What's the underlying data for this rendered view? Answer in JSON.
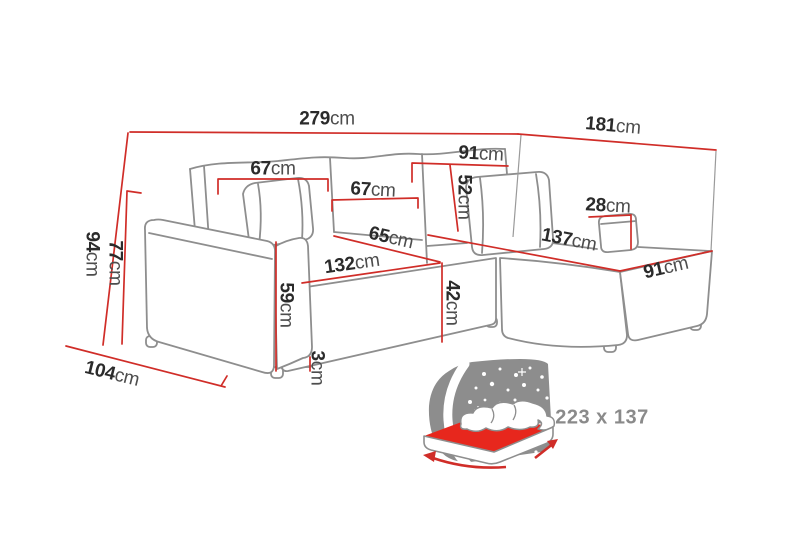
{
  "diagram": {
    "description": "corner-sofa-with-dimensions",
    "unit": "cm",
    "colors": {
      "dimension_line_red": "#d02d28",
      "sofa_outline_gray": "#8e8e8e",
      "number_text": "#2b2b2b",
      "unit_text": "#4d4d4d",
      "icon_gray": "#8d8d8d",
      "mattress_red": "#e7271d",
      "background": "#ffffff"
    }
  },
  "dimensions": [
    {
      "name": "total-width",
      "value": "279",
      "unit": "cm"
    },
    {
      "name": "chaise-side-depth",
      "value": "181",
      "unit": "cm"
    },
    {
      "name": "backrest-section-width",
      "value": "91",
      "unit": "cm"
    },
    {
      "name": "back-cushion-left",
      "value": "67",
      "unit": "cm"
    },
    {
      "name": "back-cushion-middle",
      "value": "67",
      "unit": "cm"
    },
    {
      "name": "backrest-height",
      "value": "52",
      "unit": "cm"
    },
    {
      "name": "right-armrest-height",
      "value": "28",
      "unit": "cm"
    },
    {
      "name": "total-height",
      "value": "94",
      "unit": "cm"
    },
    {
      "name": "arm-back-height",
      "value": "77",
      "unit": "cm"
    },
    {
      "name": "chaise-length",
      "value": "137",
      "unit": "cm"
    },
    {
      "name": "seat-depth",
      "value": "65",
      "unit": "cm"
    },
    {
      "name": "seat-width",
      "value": "132",
      "unit": "cm"
    },
    {
      "name": "chaise-width",
      "value": "91",
      "unit": "cm"
    },
    {
      "name": "armrest-front-height",
      "value": "59",
      "unit": "cm"
    },
    {
      "name": "seat-height",
      "value": "42",
      "unit": "cm"
    },
    {
      "name": "armrest-side-depth",
      "value": "104",
      "unit": "cm"
    },
    {
      "name": "leg-height",
      "value": "3",
      "unit": "cm"
    }
  ],
  "sleeping_area": {
    "label": "223 x 137"
  }
}
